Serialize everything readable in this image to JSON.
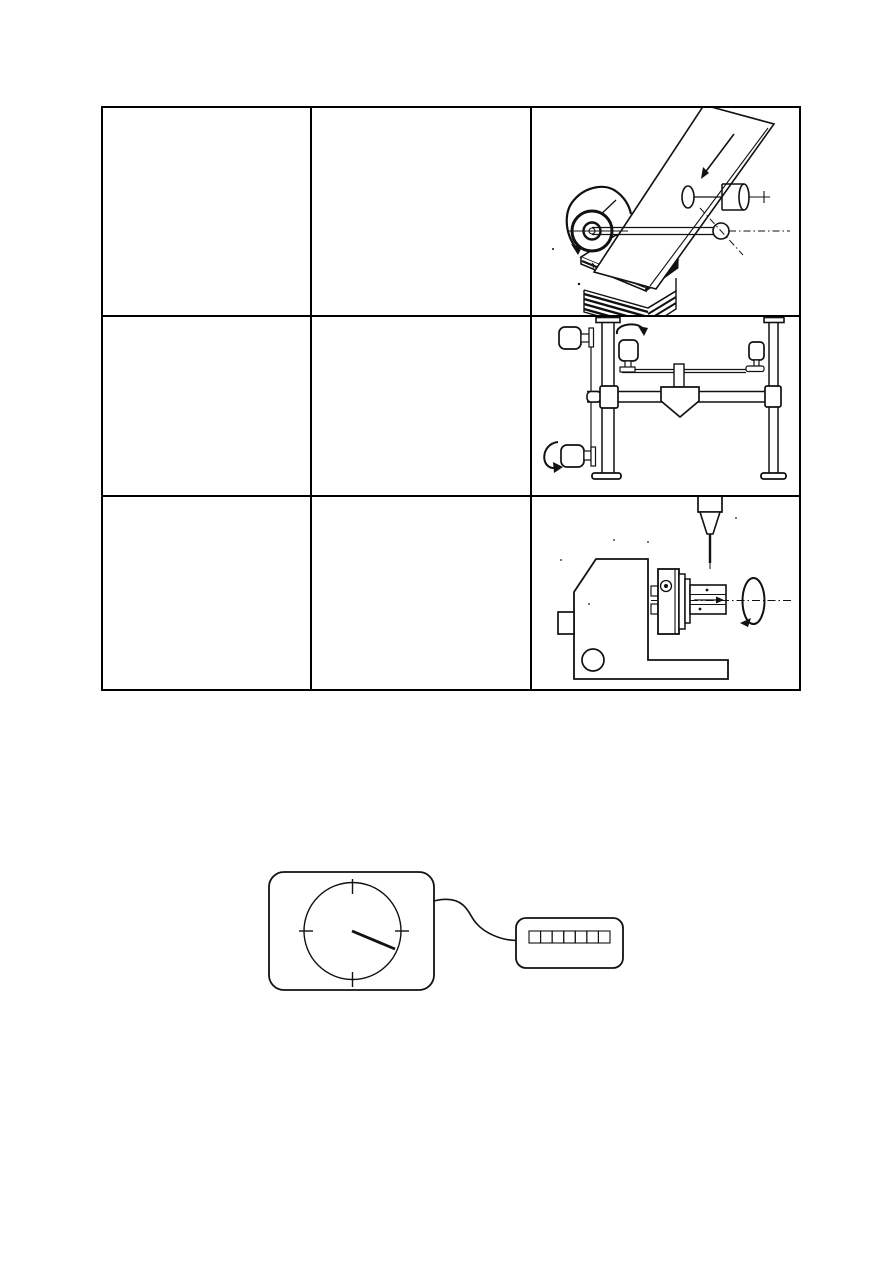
{
  "page": {
    "background_color": "#ffffff",
    "ink_color": "#111111",
    "width_px": 893,
    "height_px": 1263
  },
  "table": {
    "rows": 3,
    "columns": 3,
    "border_color": "#000000",
    "cells": [
      [
        {
          "text": ""
        },
        {
          "text": ""
        },
        {
          "figure": "circular-sawing"
        }
      ],
      [
        {
          "text": ""
        },
        {
          "text": ""
        },
        {
          "figure": "clamping-frame"
        }
      ],
      [
        {
          "text": ""
        },
        {
          "text": ""
        },
        {
          "figure": "horizontal-boring"
        }
      ]
    ],
    "figures": {
      "circular-sawing": {
        "name": "circular-saw-cutting-illustration",
        "elements": [
          "tilted board with feed arrow",
          "circular saw blade with rotation arc arrow",
          "spindle shaft with dash-dot axis and end ball",
          "pressure roller with axis arrow",
          "stack of sawn boards"
        ]
      },
      "clamping-frame": {
        "name": "frame-stand-with-clamp-motors",
        "elements": [
          "two flanged columns",
          "cross beam with corner blocks",
          "center tool head",
          "upper rail",
          "four clamp motors",
          "two rotation arrows"
        ]
      },
      "horizontal-boring": {
        "name": "horizontal-spindle-machine-with-vertical-drill",
        "elements": [
          "machine body with base foot and hole",
          "side knob",
          "stepped spindle discs",
          "square workpiece bar with feed arrow",
          "dash-dot center line",
          "rotation ellipse arrow",
          "vertical drill chuck and bit"
        ]
      }
    }
  },
  "diagram": {
    "analog_clock": {
      "tick_marks": 4,
      "hands": 1,
      "hand_direction": "toward-4-oclock"
    },
    "digital_counter": {
      "cells": 7
    },
    "connection": "s-curved-wire"
  }
}
